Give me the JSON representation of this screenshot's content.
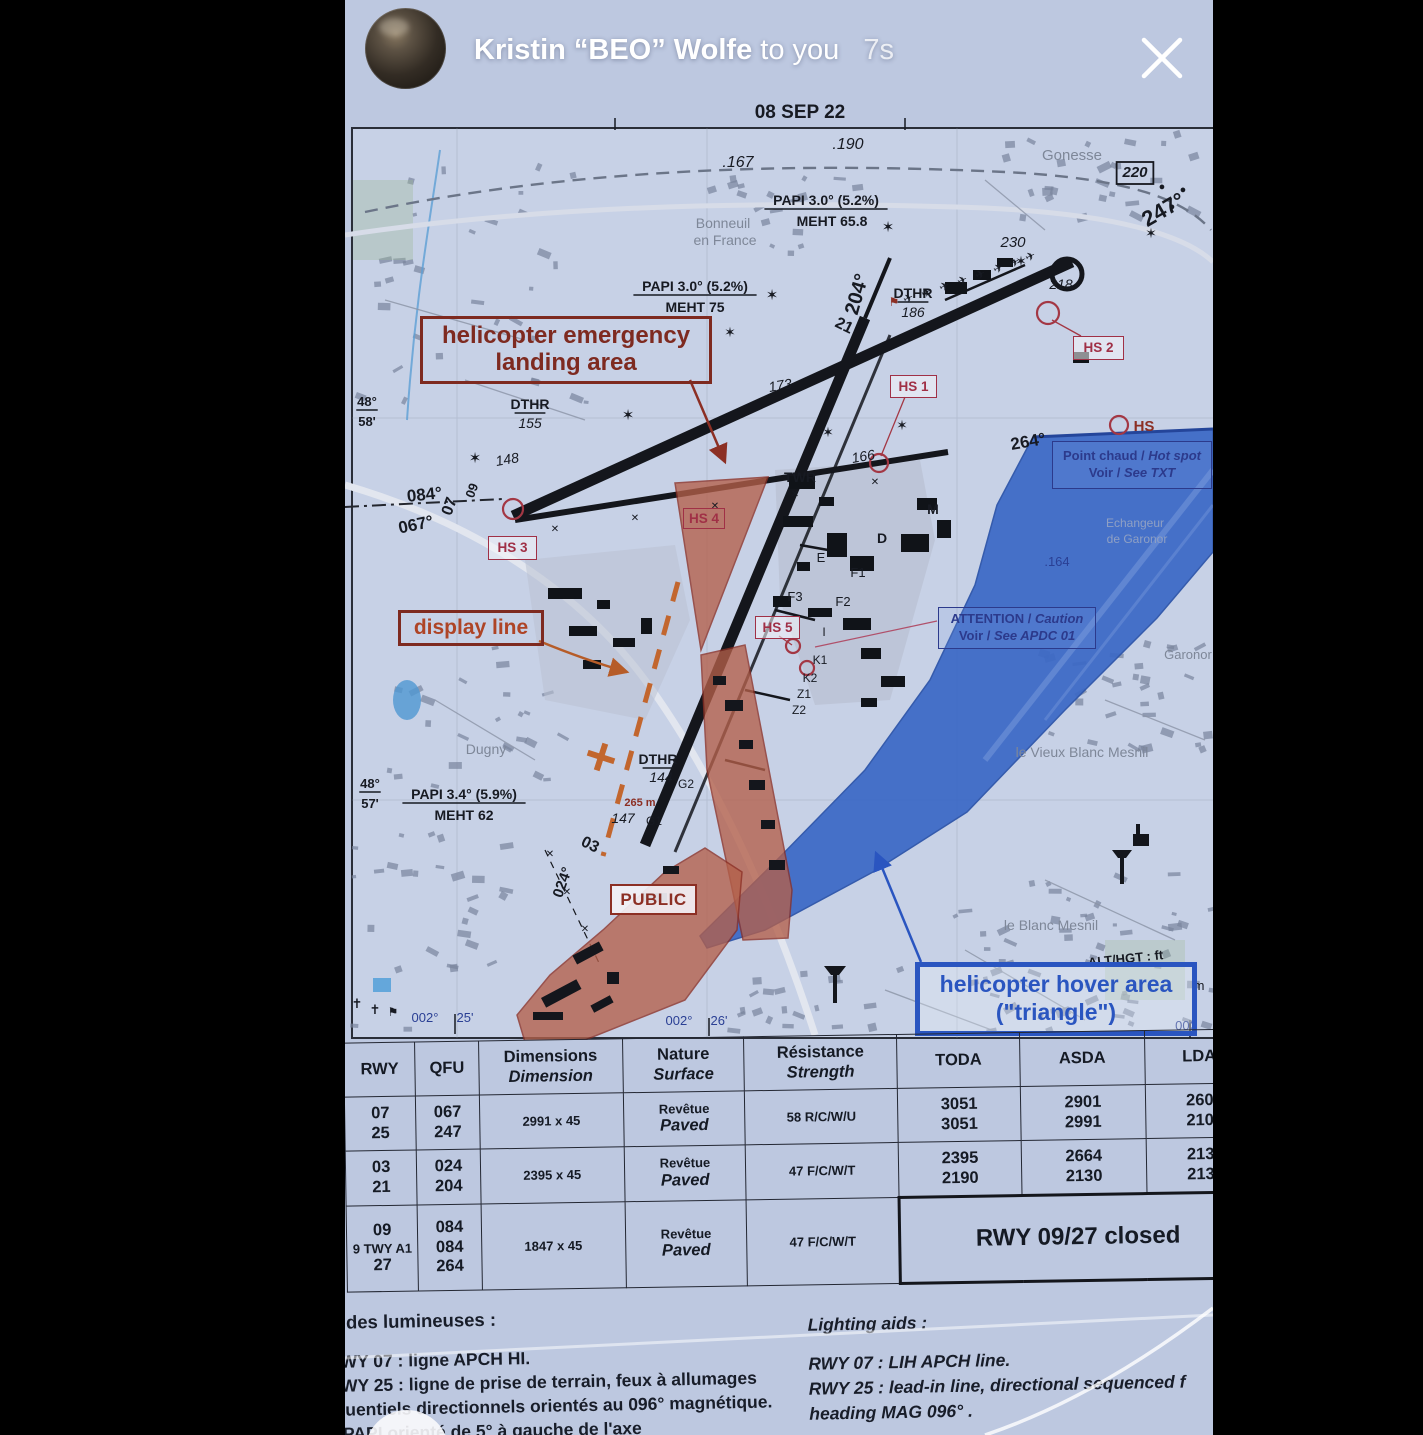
{
  "story": {
    "sender": "Kristin “BEO” Wolfe",
    "suffix": "to you",
    "timestamp": "7s"
  },
  "document_fragments": {
    "left": "ERO",
    "right": "MA"
  },
  "map": {
    "boxes": {
      "heli": {
        "l1": "helicopter emergency",
        "l2": "landing area"
      },
      "display": {
        "l1": "display line"
      },
      "public": {
        "l1": "PUBLIC"
      },
      "hs1": "HS 1",
      "hs2": "HS 2",
      "hs3": "HS 3",
      "hs4": "HS 4",
      "hs5": "HS 5",
      "hotspot": {
        "l1a": "Point chaud /",
        "l1b": "Hot spot",
        "l2a": "Voir /",
        "l2b": "See TXT"
      },
      "attention": {
        "l1a": "ATTENTION /",
        "l1b": "Caution",
        "l2a": "Voir /",
        "l2b": "See APDC 01"
      },
      "hover": {
        "l1": "helicopter hover area",
        "l2": "(\"triangle\")"
      }
    },
    "labels": [
      {
        "t": "08 SEP 22",
        "x": 455,
        "y": 118,
        "s": 19,
        "b": 1
      },
      {
        "t": ".190",
        "x": 503,
        "y": 149,
        "s": 16,
        "i": 1
      },
      {
        "t": ".167",
        "x": 393,
        "y": 167,
        "s": 16,
        "i": 1
      },
      {
        "t": "Gonesse",
        "x": 727,
        "y": 160,
        "s": 15,
        "c": "town"
      },
      {
        "t": "220",
        "x": 790,
        "y": 177,
        "s": 15,
        "b": 1,
        "i": 1,
        "box": 1
      },
      {
        "t": "247°",
        "x": 822,
        "y": 216,
        "s": 22,
        "b": 1,
        "r": -30
      },
      {
        "t": "●",
        "x": 817,
        "y": 190,
        "s": 11
      },
      {
        "t": "●",
        "x": 838,
        "y": 193,
        "s": 11
      },
      {
        "t": "●",
        "x": 827,
        "y": 210,
        "s": 11
      },
      {
        "t": "230",
        "x": 668,
        "y": 247,
        "s": 15,
        "i": 1
      },
      {
        "t": "✶",
        "x": 676,
        "y": 266,
        "s": 14
      },
      {
        "t": "✶",
        "x": 806,
        "y": 238,
        "s": 14
      },
      {
        "t": "PAPI 3.0° (5.2%)",
        "x": 481,
        "y": 205,
        "s": 14,
        "b": 1,
        "u": 1
      },
      {
        "t": "MEHT 65.8",
        "x": 487,
        "y": 226,
        "s": 14,
        "b": 1
      },
      {
        "t": "✶",
        "x": 543,
        "y": 232,
        "s": 15
      },
      {
        "t": "Bonneuil",
        "x": 378,
        "y": 228,
        "s": 14,
        "c": "town"
      },
      {
        "t": "en France",
        "x": 380,
        "y": 245,
        "s": 14,
        "c": "town"
      },
      {
        "t": "PAPI 3.0° (5.2%)",
        "x": 350,
        "y": 291,
        "s": 14,
        "b": 1,
        "u": 1
      },
      {
        "t": "MEHT 75",
        "x": 350,
        "y": 312,
        "s": 14,
        "b": 1
      },
      {
        "t": "✶",
        "x": 427,
        "y": 300,
        "s": 15
      },
      {
        "t": "204°",
        "x": 518,
        "y": 296,
        "s": 20,
        "b": 1,
        "r": -74
      },
      {
        "t": "DTHR",
        "x": 568,
        "y": 298,
        "s": 14,
        "b": 1,
        "u": 1
      },
      {
        "t": "186",
        "x": 568,
        "y": 317,
        "s": 14,
        "i": 1
      },
      {
        "t": "218",
        "x": 716,
        "y": 289,
        "s": 14,
        "i": 1
      },
      {
        "t": "21",
        "x": 497,
        "y": 330,
        "s": 16,
        "b": 1,
        "r": 26
      },
      {
        "t": "173",
        "x": 436,
        "y": 390,
        "s": 14,
        "i": 1,
        "r": -10
      },
      {
        "t": "DTHR",
        "x": 185,
        "y": 409,
        "s": 14,
        "b": 1,
        "u": 1
      },
      {
        "t": "155",
        "x": 185,
        "y": 428,
        "s": 14,
        "i": 1
      },
      {
        "t": "148",
        "x": 163,
        "y": 464,
        "s": 14,
        "i": 1,
        "r": -10
      },
      {
        "t": "✶",
        "x": 130,
        "y": 463,
        "s": 15
      },
      {
        "t": "✶",
        "x": 283,
        "y": 420,
        "s": 15
      },
      {
        "t": "✶",
        "x": 385,
        "y": 337,
        "s": 14
      },
      {
        "t": "✶",
        "x": 483,
        "y": 437,
        "s": 14
      },
      {
        "t": "✶",
        "x": 557,
        "y": 430,
        "s": 14
      },
      {
        "t": "48°",
        "x": 22,
        "y": 406,
        "s": 13,
        "b": 1,
        "u": 1
      },
      {
        "t": "58'",
        "x": 22,
        "y": 426,
        "s": 13,
        "b": 1
      },
      {
        "t": "084°",
        "x": 80,
        "y": 500,
        "s": 17,
        "b": 1,
        "r": -6
      },
      {
        "t": "067°",
        "x": 72,
        "y": 530,
        "s": 17,
        "b": 1,
        "r": -12
      },
      {
        "t": "07",
        "x": 109,
        "y": 508,
        "s": 16,
        "b": 1,
        "r": -70
      },
      {
        "t": "09",
        "x": 131,
        "y": 492,
        "s": 13,
        "b": 1,
        "r": -70
      },
      {
        "t": "166",
        "x": 519,
        "y": 461,
        "s": 14,
        "i": 1,
        "r": -10
      },
      {
        "t": "TWR",
        "x": 455,
        "y": 482,
        "s": 14,
        "b": 1
      },
      {
        "t": "M",
        "x": 588,
        "y": 514,
        "s": 14,
        "b": 1
      },
      {
        "t": "D",
        "x": 537,
        "y": 543,
        "s": 14,
        "b": 1
      },
      {
        "t": "E",
        "x": 476,
        "y": 562,
        "s": 13
      },
      {
        "t": "F1",
        "x": 513,
        "y": 577,
        "s": 13
      },
      {
        "t": "F3",
        "x": 450,
        "y": 601,
        "s": 13
      },
      {
        "t": "F2",
        "x": 498,
        "y": 606,
        "s": 13
      },
      {
        "t": "I",
        "x": 479,
        "y": 636,
        "s": 12
      },
      {
        "t": "K1",
        "x": 475,
        "y": 664,
        "s": 12
      },
      {
        "t": "K2",
        "x": 465,
        "y": 682,
        "s": 12
      },
      {
        "t": "Z1",
        "x": 459,
        "y": 698,
        "s": 12
      },
      {
        "t": "Z2",
        "x": 454,
        "y": 714,
        "s": 12
      },
      {
        "t": ".164",
        "x": 712,
        "y": 566,
        "s": 13,
        "c": "navy"
      },
      {
        "t": "Echangeur",
        "x": 790,
        "y": 527,
        "s": 12,
        "c": "faint"
      },
      {
        "t": "de Garonor",
        "x": 792,
        "y": 543,
        "s": 12,
        "c": "faint"
      },
      {
        "t": "Garonor",
        "x": 843,
        "y": 659,
        "s": 13,
        "c": "town"
      },
      {
        "t": "264°",
        "x": 684,
        "y": 447,
        "s": 17,
        "b": 1,
        "r": -10
      },
      {
        "t": "HS",
        "x": 799,
        "y": 431,
        "s": 15,
        "c": "red",
        "b": 1
      },
      {
        "t": "le Vieux Blanc Mesnil",
        "x": 737,
        "y": 757,
        "s": 14,
        "c": "town"
      },
      {
        "t": "le Blanc Mesnil",
        "x": 706,
        "y": 930,
        "s": 14,
        "c": "town"
      },
      {
        "t": "Dugny",
        "x": 141,
        "y": 754,
        "s": 14,
        "c": "town"
      },
      {
        "t": "48°",
        "x": 25,
        "y": 788,
        "s": 13,
        "b": 1,
        "u": 1
      },
      {
        "t": "57'",
        "x": 25,
        "y": 808,
        "s": 13,
        "b": 1
      },
      {
        "t": "PAPI 3.4° (5.9%)",
        "x": 119,
        "y": 799,
        "s": 14,
        "b": 1,
        "u": 1
      },
      {
        "t": "MEHT 62",
        "x": 119,
        "y": 820,
        "s": 14,
        "b": 1
      },
      {
        "t": "DTHR",
        "x": 313,
        "y": 764,
        "s": 14,
        "b": 1,
        "u": 1
      },
      {
        "t": "144",
        "x": 316,
        "y": 782,
        "s": 14,
        "i": 1
      },
      {
        "t": "G2",
        "x": 341,
        "y": 788,
        "s": 12
      },
      {
        "t": "265 m",
        "x": 295,
        "y": 806,
        "s": 11,
        "c": "red",
        "b": 1
      },
      {
        "t": "147",
        "x": 278,
        "y": 823,
        "s": 14,
        "i": 1
      },
      {
        "t": "G1",
        "x": 309,
        "y": 825,
        "s": 12
      },
      {
        "t": "03",
        "x": 243,
        "y": 849,
        "s": 16,
        "b": 1,
        "r": 26
      },
      {
        "t": "024°",
        "x": 222,
        "y": 884,
        "s": 15,
        "b": 1,
        "r": -70
      },
      {
        "t": "ALT/HGT : ft",
        "x": 781,
        "y": 963,
        "s": 13,
        "b": 1,
        "r": -6
      },
      {
        "t": "m",
        "x": 854,
        "y": 990,
        "s": 13
      },
      {
        "t": "002°",
        "x": 80,
        "y": 1022,
        "s": 13,
        "c": "navy"
      },
      {
        "t": "25'",
        "x": 120,
        "y": 1022,
        "s": 13,
        "c": "navy"
      },
      {
        "t": "002°",
        "x": 334,
        "y": 1025,
        "s": 13,
        "c": "navy"
      },
      {
        "t": "26'",
        "x": 374,
        "y": 1025,
        "s": 13,
        "c": "navy"
      },
      {
        "t": "002",
        "x": 841,
        "y": 1030,
        "s": 13,
        "c": "navy"
      },
      {
        "t": "✝",
        "x": 12,
        "y": 1008,
        "s": 13
      },
      {
        "t": "✝",
        "x": 30,
        "y": 1014,
        "s": 13
      },
      {
        "t": "⚑",
        "x": 48,
        "y": 1016,
        "s": 12
      },
      {
        "t": "⚑",
        "x": 549,
        "y": 306,
        "s": 12,
        "c": "red"
      },
      {
        "t": "✈",
        "x": 565,
        "y": 302,
        "s": 12,
        "r": -25
      },
      {
        "t": "✈",
        "x": 583,
        "y": 296,
        "s": 12,
        "r": -25
      },
      {
        "t": "✈",
        "x": 601,
        "y": 290,
        "s": 12,
        "r": -25
      },
      {
        "t": "✈",
        "x": 619,
        "y": 284,
        "s": 12,
        "r": -25
      },
      {
        "t": "✈",
        "x": 637,
        "y": 278,
        "s": 12,
        "r": -25
      },
      {
        "t": "✈",
        "x": 655,
        "y": 272,
        "s": 12,
        "r": -25
      },
      {
        "t": "✈",
        "x": 671,
        "y": 266,
        "s": 12,
        "r": -25
      },
      {
        "t": "✈",
        "x": 687,
        "y": 260,
        "s": 12,
        "r": -25
      },
      {
        "t": "✕",
        "x": 210,
        "y": 532,
        "s": 10
      },
      {
        "t": "✕",
        "x": 290,
        "y": 521,
        "s": 10
      },
      {
        "t": "✕",
        "x": 370,
        "y": 509,
        "s": 10
      },
      {
        "t": "✕",
        "x": 450,
        "y": 497,
        "s": 10
      },
      {
        "t": "✕",
        "x": 530,
        "y": 485,
        "s": 10
      },
      {
        "t": "✕",
        "x": 205,
        "y": 857,
        "s": 10
      },
      {
        "t": "✕",
        "x": 222,
        "y": 895,
        "s": 10
      },
      {
        "t": "✕",
        "x": 240,
        "y": 932,
        "s": 10
      }
    ],
    "texture_regions": [
      {
        "x": 690,
        "y": 640,
        "w": 178,
        "h": 118,
        "n": 30,
        "seed": 7
      },
      {
        "x": 600,
        "y": 870,
        "w": 268,
        "h": 160,
        "n": 55,
        "seed": 11
      },
      {
        "x": 380,
        "y": 962,
        "w": 190,
        "h": 66,
        "n": 20,
        "seed": 3
      },
      {
        "x": 10,
        "y": 150,
        "w": 230,
        "h": 260,
        "n": 32,
        "seed": 5
      },
      {
        "x": 620,
        "y": 132,
        "w": 240,
        "h": 92,
        "n": 26,
        "seed": 9
      },
      {
        "x": 330,
        "y": 152,
        "w": 180,
        "h": 100,
        "n": 18,
        "seed": 13
      },
      {
        "x": 40,
        "y": 632,
        "w": 190,
        "h": 155,
        "n": 24,
        "seed": 17
      },
      {
        "x": 0,
        "y": 830,
        "w": 160,
        "h": 200,
        "n": 28,
        "seed": 19
      }
    ]
  },
  "table": {
    "headers": [
      {
        "lines": [
          "RWY"
        ]
      },
      {
        "lines": [
          "QFU"
        ]
      },
      {
        "lines": [
          "Dimensions",
          "Dimension"
        ]
      },
      {
        "lines": [
          "Nature",
          "Surface"
        ]
      },
      {
        "lines": [
          "Résistance",
          "Strength"
        ]
      },
      {
        "lines": [
          "TODA"
        ]
      },
      {
        "lines": [
          "ASDA"
        ]
      },
      {
        "lines": [
          "LDA"
        ]
      }
    ],
    "rows": [
      {
        "rwy": [
          "07",
          "25"
        ],
        "qfu": [
          "067",
          "247"
        ],
        "dim": [
          "2991 x 45"
        ],
        "nat": [
          "Revêtue",
          "Paved"
        ],
        "res": [
          "58 R/C/W/U"
        ],
        "toda": [
          "3051",
          "3051"
        ],
        "asda": [
          "2901",
          "2991"
        ],
        "lda": [
          "260",
          "210"
        ]
      },
      {
        "rwy": [
          "03",
          "21"
        ],
        "qfu": [
          "024",
          "204"
        ],
        "dim": [
          "2395 x 45"
        ],
        "nat": [
          "Revêtue",
          "Paved"
        ],
        "res": [
          "47 F/C/W/T"
        ],
        "toda": [
          "2395",
          "2190"
        ],
        "asda": [
          "2664",
          "2130"
        ],
        "lda": [
          "213",
          "213"
        ]
      },
      {
        "rwy": [
          "09",
          "9 TWY A1",
          "27"
        ],
        "qfu": [
          "084",
          "084",
          "264"
        ],
        "dim": [
          "1847 x 45"
        ],
        "nat": [
          "Revêtue",
          "Paved"
        ],
        "res": [
          "47 F/C/W/T"
        ],
        "merged": "RWY 09/27 closed"
      }
    ]
  },
  "footer": {
    "fr_title": "Aides lumineuses :",
    "fr_lines": [
      "RWY 07 : ligne APCH HI.",
      "RWY 25 : ligne de prise de terrain, feux à allumages",
      "séquentiels directionnels orientés au 096° magnétique.",
      "le PAPI orienté de 5° à gauche de l'axe"
    ],
    "en_title": "Lighting aids :",
    "en_lines": [
      "RWY 07 : LIH APCH line.",
      "RWY 25 : lead-in line, directional sequenced f",
      "heading MAG 096° ."
    ]
  },
  "colors": {
    "maroon": "#8c2f24",
    "navy_box": "#2c3a8c",
    "hover_blue": "#2a55c0",
    "ctr_blue": "#3c69c6",
    "paper": "#c7d1e6",
    "letterbox": "#000000"
  }
}
